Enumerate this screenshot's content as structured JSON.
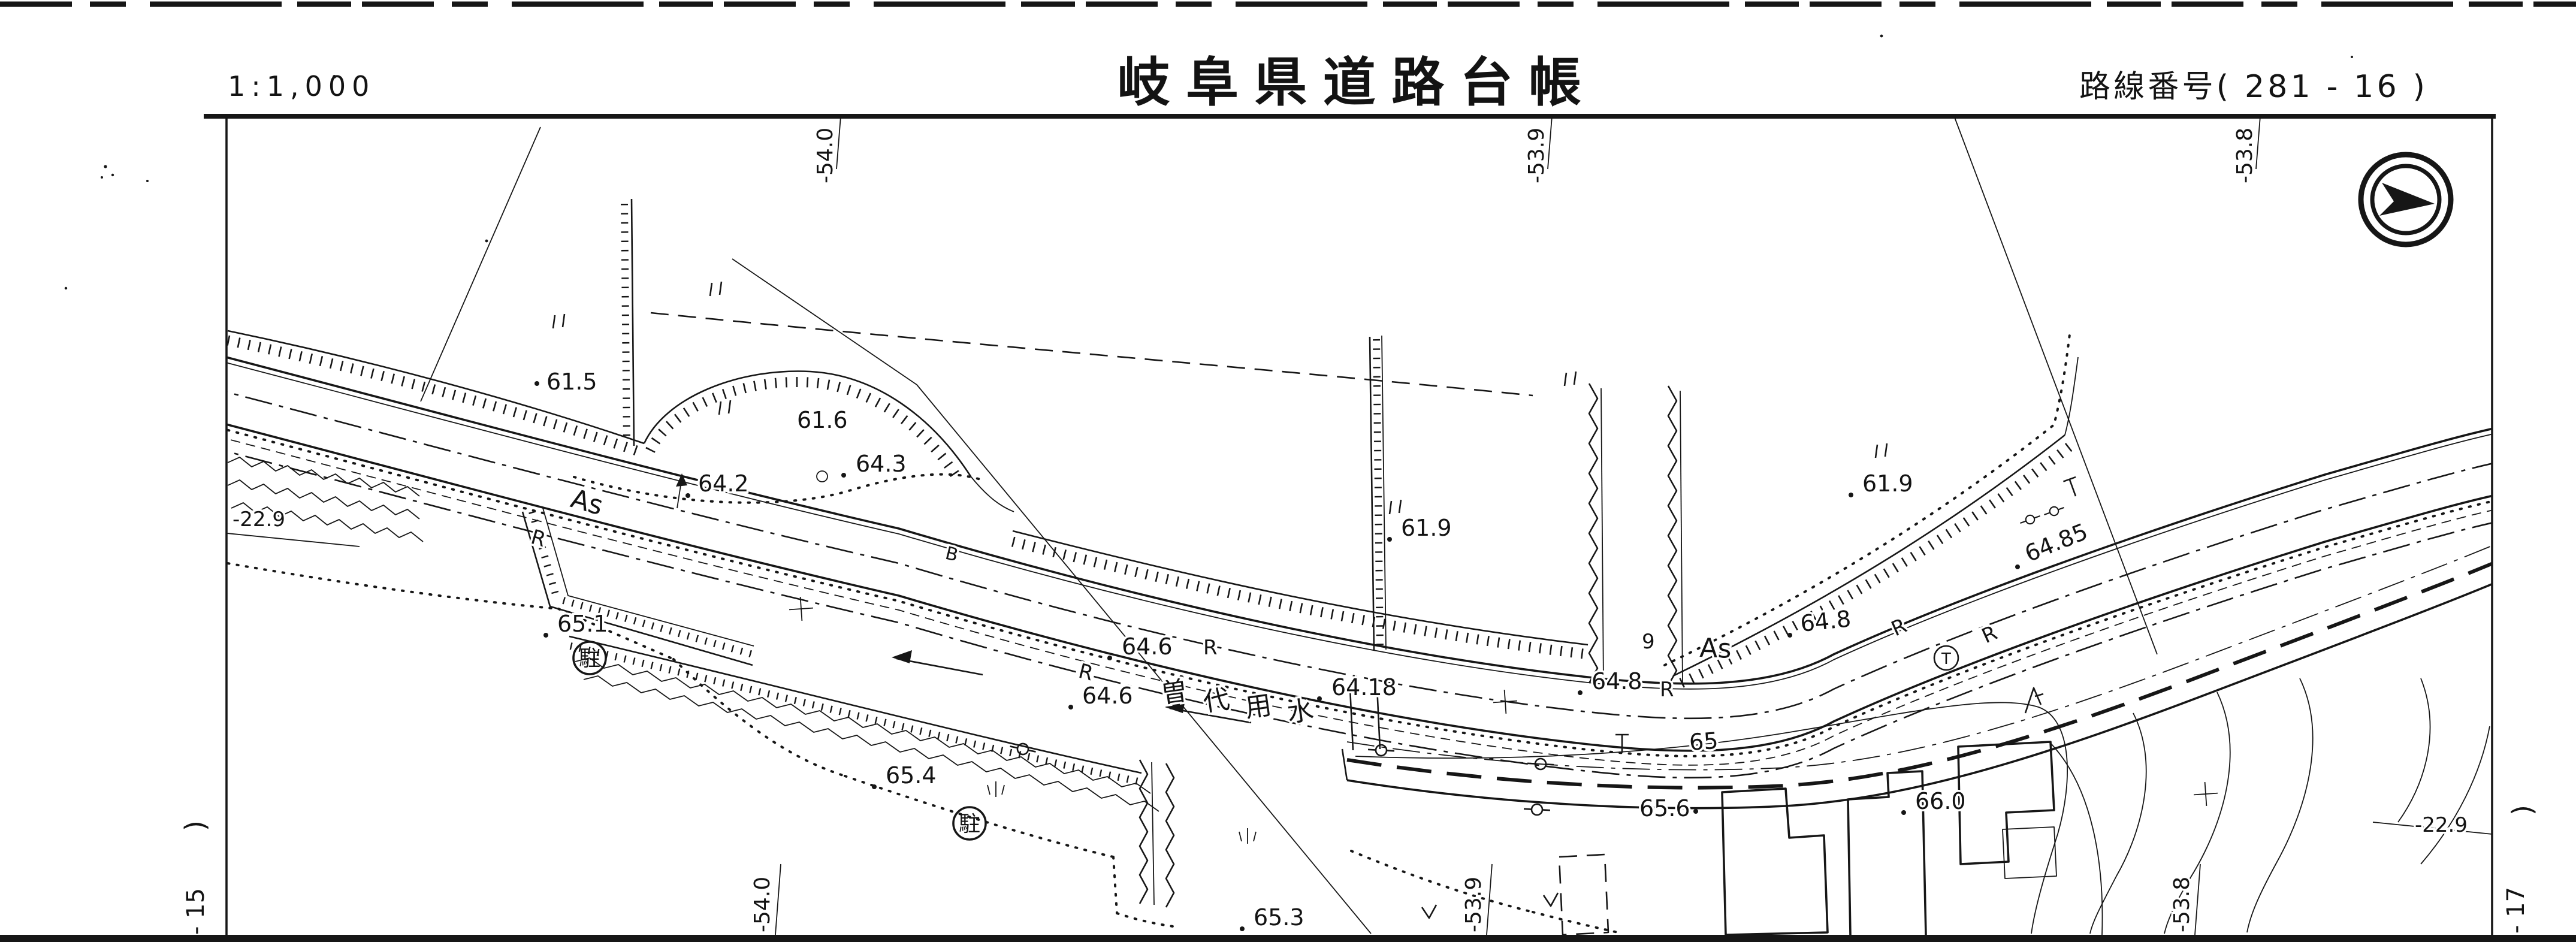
{
  "header": {
    "scale_label": "1:1,000",
    "title": "岐阜県道路台帳",
    "route_label": "路線番号( 281 - 16 )"
  },
  "grid": {
    "top_labels": [
      "-54.0",
      "-53.9",
      "-53.8"
    ],
    "bottom_labels": [
      "-54.0",
      "-53.9",
      "-53.8"
    ],
    "left_label": "-22.9",
    "right_label": "-22.9"
  },
  "sheet_joins": {
    "left_paren": ")",
    "left_number": "- 15",
    "right_paren": "(",
    "right_number": "- 17"
  },
  "map": {
    "road_name": "曽代用水",
    "canal_chars": [
      "曽",
      "代",
      "用",
      "水"
    ],
    "labels": [
      {
        "text": "61.5"
      },
      {
        "text": "61.6"
      },
      {
        "text": "64.3"
      },
      {
        "text": "64.2"
      },
      {
        "text": "As"
      },
      {
        "text": "R"
      },
      {
        "text": "B"
      },
      {
        "text": "64.6"
      },
      {
        "text": "R"
      },
      {
        "text": "R"
      },
      {
        "text": "64.6"
      },
      {
        "text": "64.18"
      },
      {
        "text": "61.9"
      },
      {
        "text": "64.8"
      },
      {
        "text": "R"
      },
      {
        "text": "9"
      },
      {
        "text": "As"
      },
      {
        "text": "64.8"
      },
      {
        "text": "61.9"
      },
      {
        "text": "64.85"
      },
      {
        "text": "R"
      },
      {
        "text": "R"
      },
      {
        "text": "65"
      },
      {
        "text": "65.6"
      },
      {
        "text": "65.3"
      },
      {
        "text": "65.4"
      },
      {
        "text": "65.1"
      },
      {
        "text": "66.0"
      }
    ],
    "circled_labels": [
      {
        "text": "駐"
      },
      {
        "text": "駐"
      },
      {
        "text": "T"
      }
    ]
  },
  "icons": {
    "north_arrow": "compass-north-arrow",
    "paddy_marks": "rice-field-symbol",
    "grass_marks": "grass-tuft-symbol",
    "pole_marks": "utility-pole-symbol",
    "tree_mark": "tree-symbol"
  }
}
